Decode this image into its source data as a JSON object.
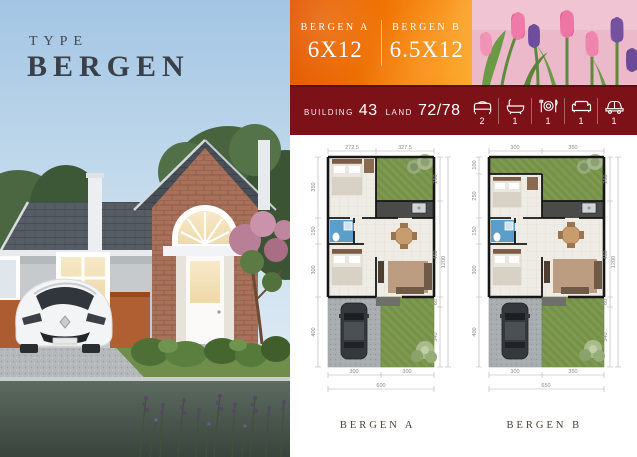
{
  "photo": {
    "type_label": "TYPE",
    "title": "BERGEN"
  },
  "banner": {
    "variants": [
      {
        "name": "BERGEN A",
        "size": "6X12"
      },
      {
        "name": "BERGEN B",
        "size": "6.5X12"
      }
    ]
  },
  "specs": {
    "building_label": "BUILDING",
    "building_value": "43",
    "land_label": "LAND",
    "land_value": "72/78",
    "amenities": [
      {
        "icon": "bed-icon",
        "count": "2"
      },
      {
        "icon": "bathtub-icon",
        "count": "1"
      },
      {
        "icon": "dining-icon",
        "count": "1"
      },
      {
        "icon": "sofa-icon",
        "count": "1"
      },
      {
        "icon": "car-icon",
        "count": "1"
      }
    ]
  },
  "plans": {
    "a": {
      "name": "BERGEN A",
      "top": [
        "272.5",
        "327.5"
      ],
      "left": [
        "350",
        "150",
        "300",
        "400"
      ],
      "right": [
        "250",
        "450",
        "60",
        "340"
      ],
      "right_total": "1200",
      "bottom": [
        "300",
        "300"
      ],
      "bottom_total": "600"
    },
    "b": {
      "name": "BERGEN B",
      "top": [
        "300",
        "350"
      ],
      "left": [
        "100",
        "250",
        "150",
        "300",
        "400"
      ],
      "right": [
        "250",
        "450",
        "60",
        "340"
      ],
      "right_total": "1200",
      "bottom": [
        "300",
        "350"
      ],
      "bottom_total": "650"
    }
  },
  "colors": {
    "accent_orange": "#f47a04",
    "maroon": "#7c1117",
    "title_text": "#394049",
    "plan_lawn": "#7e9a4e",
    "plan_bathroom": "#5b9ec9"
  }
}
